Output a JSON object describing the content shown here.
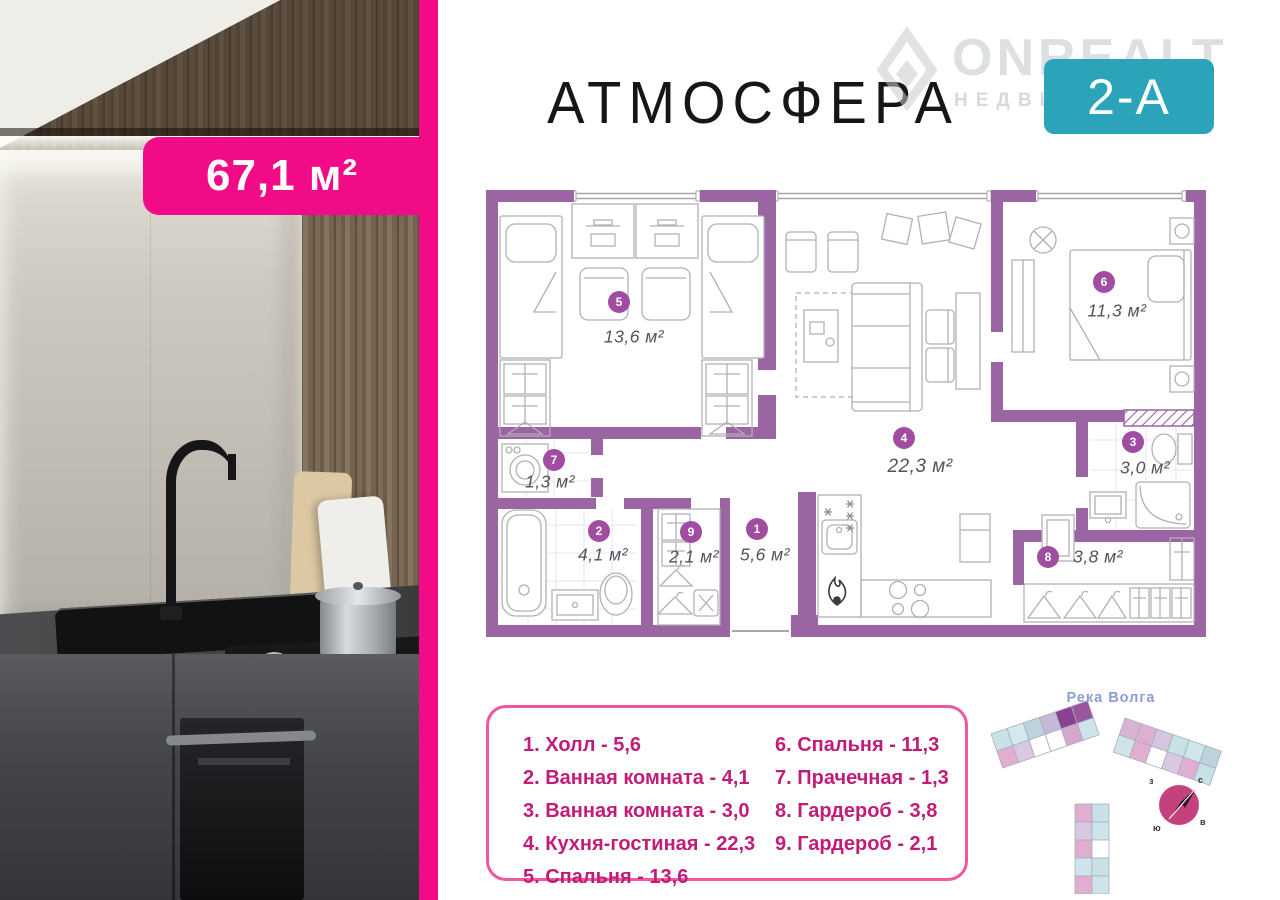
{
  "photo": {
    "area_badge": "67,1 м²"
  },
  "header": {
    "brand": "АТМОСФЕРА",
    "unit_badge": "2-А",
    "watermark": {
      "line1": "ONREALT",
      "line2": "НЕДВИЖИМОСТЬ"
    }
  },
  "floorplan": {
    "rooms": [
      {
        "num": "1",
        "area": "5,6 м²"
      },
      {
        "num": "2",
        "area": "4,1 м²"
      },
      {
        "num": "3",
        "area": "3,0 м²"
      },
      {
        "num": "4",
        "area": "22,3 м²"
      },
      {
        "num": "5",
        "area": "13,6 м²"
      },
      {
        "num": "6",
        "area": "11,3 м²"
      },
      {
        "num": "7",
        "area": "1,3 м²"
      },
      {
        "num": "8",
        "area": "3,8 м²"
      },
      {
        "num": "9",
        "area": "2,1 м²"
      }
    ]
  },
  "legend": {
    "left_column": [
      "1. Холл - 5,6",
      "2. Ванная комната - 4,1",
      "3. Ванная комната - 3,0",
      "4. Кухня-гостиная - 22,3",
      "5. Спальня - 13,6"
    ],
    "right_column": [
      "6. Спальня - 11,3",
      "7. Прачечная - 1,3",
      "8. Гардероб - 3,8",
      "9. Гардероб - 2,1"
    ]
  },
  "siteplan": {
    "river_label": "Река Волга",
    "compass": {
      "n": "с",
      "e": "в",
      "s": "ю",
      "w": "з"
    }
  },
  "colors": {
    "accent_pink": "#f20b86",
    "legend_pink": "#c11d78",
    "wall_purple": "#9b64a3",
    "badge_purple": "#a04da1",
    "unit_teal": "#2ba4b9"
  }
}
